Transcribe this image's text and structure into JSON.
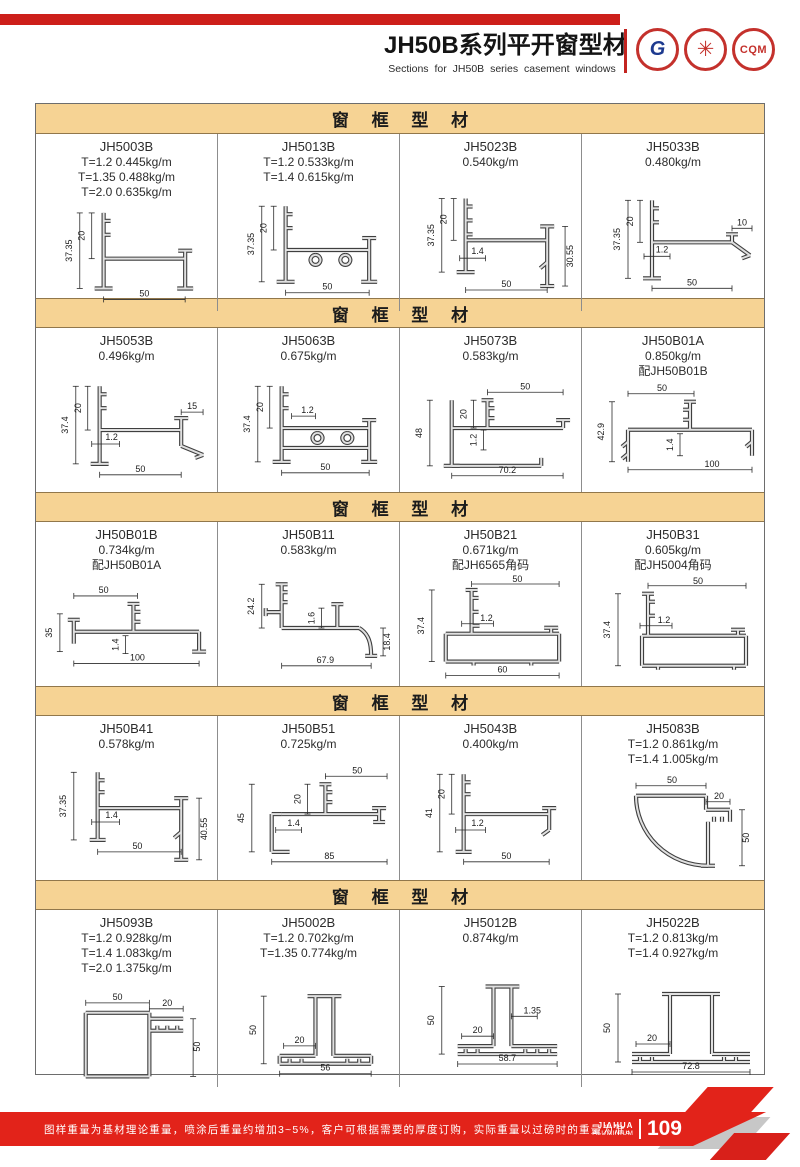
{
  "page": {
    "title": "JH50B系列平开窗型材",
    "subtitle": "Sections for JH50B series casement windows",
    "logos": {
      "gb": "G",
      "star": "✳",
      "cqm": "CQM"
    }
  },
  "sections": [
    {
      "header": "窗 框 型 材",
      "cells": [
        {
          "code": "JH5003B",
          "specs": [
            "T=1.2 0.445kg/m",
            "T=1.35 0.488kg/m",
            "T=2.0 0.635kg/m"
          ],
          "dims": [
            "37.35",
            "20",
            "50"
          ]
        },
        {
          "code": "JH5013B",
          "specs": [
            "T=1.2 0.533kg/m",
            "T=1.4 0.615kg/m"
          ],
          "dims": [
            "37.35",
            "20",
            "50"
          ]
        },
        {
          "code": "JH5023B",
          "specs": [
            "0.540kg/m"
          ],
          "dims": [
            "37.35",
            "20",
            "1.4",
            "30.55",
            "50"
          ]
        },
        {
          "code": "JH5033B",
          "specs": [
            "0.480kg/m"
          ],
          "dims": [
            "37.35",
            "20",
            "1.2",
            "10",
            "50"
          ]
        }
      ]
    },
    {
      "header": "窗 框 型 材",
      "cells": [
        {
          "code": "JH5053B",
          "specs": [
            "0.496kg/m"
          ],
          "dims": [
            "37.4",
            "20",
            "1.2",
            "15",
            "50"
          ]
        },
        {
          "code": "JH5063B",
          "specs": [
            "0.675kg/m"
          ],
          "dims": [
            "37.4",
            "20",
            "1.2",
            "50"
          ]
        },
        {
          "code": "JH5073B",
          "specs": [
            "0.583kg/m"
          ],
          "dims": [
            "48",
            "20",
            "1.2",
            "50",
            "70.2"
          ]
        },
        {
          "code": "JH50B01A",
          "specs": [
            "0.850kg/m",
            "配JH50B01B"
          ],
          "dims": [
            "42.9",
            "1.4",
            "50",
            "100"
          ]
        }
      ]
    },
    {
      "header": "窗 框 型 材",
      "cells": [
        {
          "code": "JH50B01B",
          "specs": [
            "0.734kg/m",
            "配JH50B01A"
          ],
          "dims": [
            "35",
            "50",
            "1.4",
            "100"
          ]
        },
        {
          "code": "JH50B11",
          "specs": [
            "0.583kg/m"
          ],
          "dims": [
            "24.2",
            "1.6",
            "18.4",
            "67.9"
          ]
        },
        {
          "code": "JH50B21",
          "specs": [
            "0.671kg/m",
            "配JH6565角码"
          ],
          "dims": [
            "37.4",
            "1.2",
            "50",
            "60"
          ]
        },
        {
          "code": "JH50B31",
          "specs": [
            "0.605kg/m",
            "配JH5004角码"
          ],
          "dims": [
            "37.4",
            "1.2",
            "50"
          ]
        }
      ]
    },
    {
      "header": "窗 框 型 材",
      "cells": [
        {
          "code": "JH50B41",
          "specs": [
            "0.578kg/m"
          ],
          "dims": [
            "37.35",
            "1.4",
            "40.55",
            "50"
          ]
        },
        {
          "code": "JH50B51",
          "specs": [
            "0.725kg/m"
          ],
          "dims": [
            "45",
            "20",
            "1.4",
            "50",
            "85"
          ]
        },
        {
          "code": "JH5043B",
          "specs": [
            "0.400kg/m"
          ],
          "dims": [
            "41",
            "20",
            "1.2",
            "50"
          ]
        },
        {
          "code": "JH5083B",
          "specs": [
            "T=1.2 0.861kg/m",
            "T=1.4 1.005kg/m"
          ],
          "dims": [
            "50",
            "20",
            "50"
          ]
        }
      ]
    },
    {
      "header": "窗 框 型 材",
      "cells": [
        {
          "code": "JH5093B",
          "specs": [
            "T=1.2 0.928kg/m",
            "T=1.4 1.083kg/m",
            "T=2.0 1.375kg/m"
          ],
          "dims": [
            "50",
            "20",
            "50"
          ]
        },
        {
          "code": "JH5002B",
          "specs": [
            "T=1.2 0.702kg/m",
            "T=1.35 0.774kg/m"
          ],
          "dims": [
            "50",
            "20",
            "56"
          ]
        },
        {
          "code": "JH5012B",
          "specs": [
            "0.874kg/m"
          ],
          "dims": [
            "50",
            "20",
            "1.35",
            "58.7"
          ]
        },
        {
          "code": "JH5022B",
          "specs": [
            "T=1.2 0.813kg/m",
            "T=1.4 0.927kg/m"
          ],
          "dims": [
            "50",
            "20",
            "72.8"
          ]
        }
      ]
    }
  ],
  "footer": {
    "note": "图样重量为基材理论重量，喷涂后重量约增加3~5%，客户可根据需要的厚度订购，实际重量以过磅时的重量为准。",
    "brand_line1": "JIAHUA",
    "brand_line2": "ALUMINIUM",
    "page_number": "109"
  }
}
